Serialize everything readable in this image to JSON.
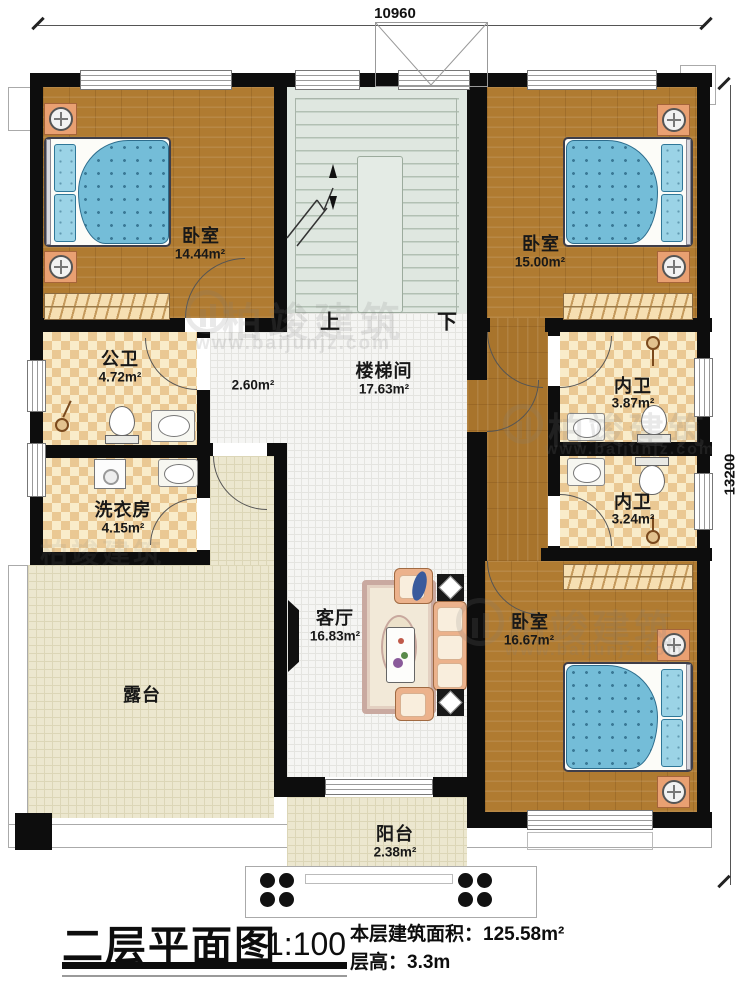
{
  "dimensions": {
    "width_top": "10960",
    "height_right": "13200"
  },
  "rooms": [
    {
      "key": "bedroom-top-left",
      "label": "卧室",
      "area": "14.44m²"
    },
    {
      "key": "bedroom-top-right",
      "label": "卧室",
      "area": "15.00m²"
    },
    {
      "key": "stairwell",
      "label": "楼梯间",
      "area": "17.63m²"
    },
    {
      "key": "corridor",
      "label": "",
      "area": "2.60m²"
    },
    {
      "key": "public-bathroom",
      "label": "公卫",
      "area": "4.72m²"
    },
    {
      "key": "laundry-room",
      "label": "洗衣房",
      "area": "4.15m²"
    },
    {
      "key": "ensuite-bathroom-1",
      "label": "内卫",
      "area": "3.87m²"
    },
    {
      "key": "ensuite-bathroom-2",
      "label": "内卫",
      "area": "3.24m²"
    },
    {
      "key": "living-room",
      "label": "客厅",
      "area": "16.83m²"
    },
    {
      "key": "bedroom-bottom-right",
      "label": "卧室",
      "area": "16.67m²"
    },
    {
      "key": "terrace",
      "label": "露台",
      "area": ""
    },
    {
      "key": "balcony",
      "label": "阳台",
      "area": "2.38m²"
    }
  ],
  "stairs": {
    "up": "上",
    "down": "下"
  },
  "title_block": {
    "title": "二层平面图",
    "scale": "1:100",
    "floor_area_label": "本层建筑面积：",
    "floor_area_value": "125.58m²",
    "floor_height_label": "层高：",
    "floor_height_value": "3.3m"
  },
  "watermark": {
    "brand": "柏竣建筑",
    "url": "www.baijunjz.com"
  }
}
